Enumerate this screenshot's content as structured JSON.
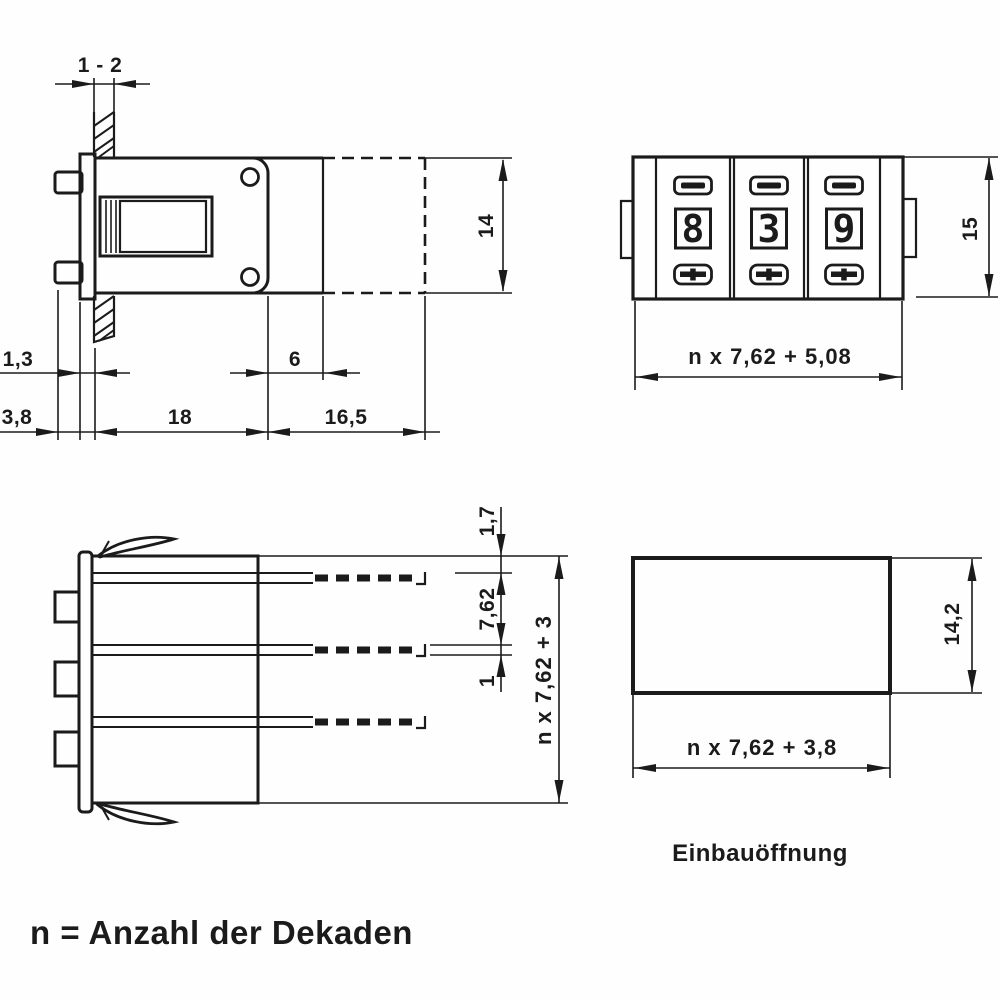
{
  "side_view": {
    "dim_panel_thickness": "1 - 2",
    "dim_height": "14",
    "dim_flange_thickness": "1,3",
    "dim_pin_offset": "3,8",
    "dim_body_depth": "18",
    "dim_bezel_depth": "6",
    "dim_rear_depth": "16,5"
  },
  "front_view": {
    "digits": [
      "8",
      "3",
      "9"
    ],
    "dim_height": "15",
    "dim_width": "n x 7,62 + 5,08"
  },
  "top_view": {
    "dim_clip_gap": "1,7",
    "dim_pin_pitch": "7,62",
    "dim_pin_width": "1",
    "dim_width": "n x 7,62 + 3"
  },
  "cutout_view": {
    "label": "Einbauöffnung",
    "dim_width": "n x 7,62 + 3,8",
    "dim_height": "14,2"
  },
  "footnote": "n = Anzahl der Dekaden"
}
